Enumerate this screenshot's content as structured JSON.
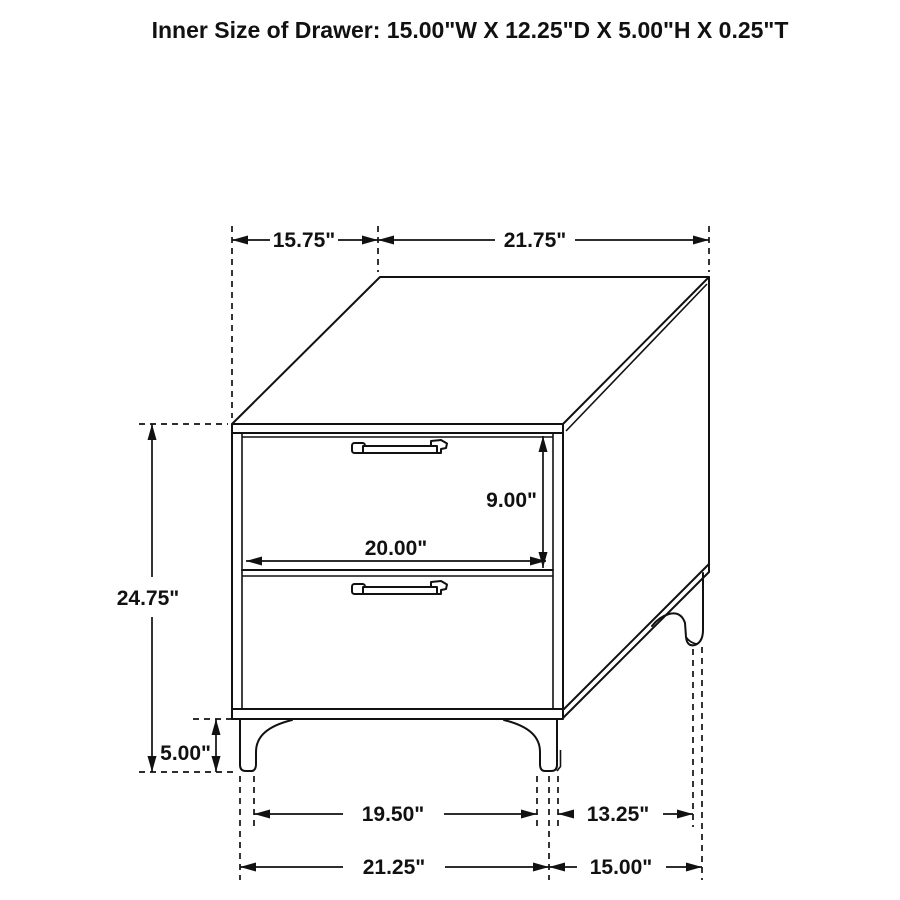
{
  "title": "Inner Size of Drawer: 15.00\"W X 12.25\"D X 5.00\"H X 0.25\"T",
  "colors": {
    "line": "#111111",
    "background": "#ffffff"
  },
  "dim": {
    "top_depth": "15.75\"",
    "top_width": "21.75\"",
    "drawer_front_height": "9.00\"",
    "drawer_front_width": "20.00\"",
    "overall_height": "24.75\"",
    "leg_height": "5.00\"",
    "front_feet_inner_span": "19.50\"",
    "side_feet_inner_span": "13.25\"",
    "front_feet_outer_span": "21.25\"",
    "side_feet_outer_span": "15.00\""
  }
}
